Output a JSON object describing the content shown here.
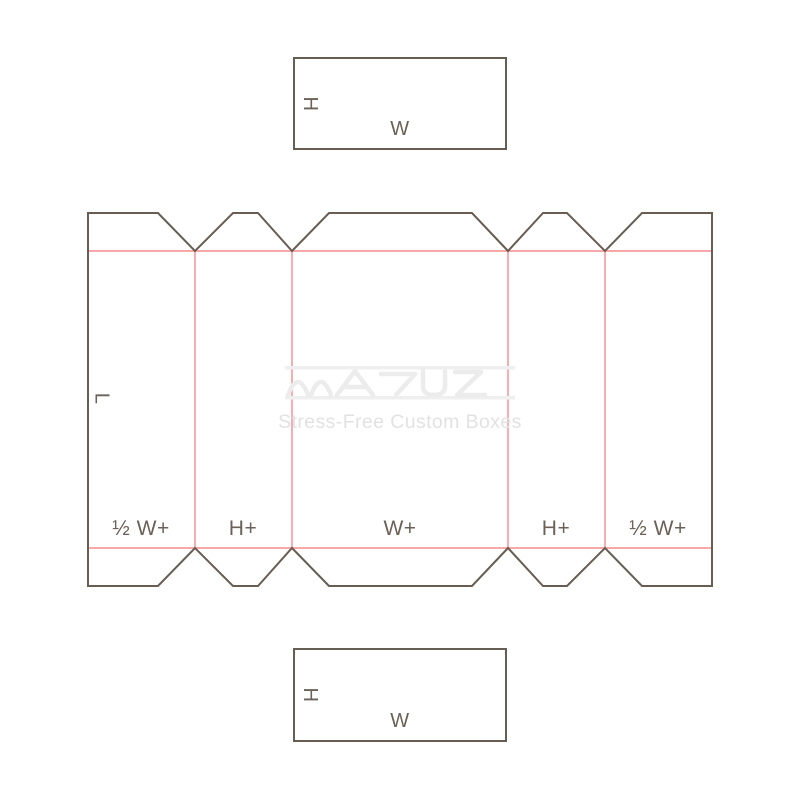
{
  "title": "Box dieline template",
  "colors": {
    "background": "#ffffff",
    "cut_line": "#675d53",
    "fold_line": "#f58b8b",
    "label_text": "#6b6158",
    "watermark_logo": "#ececec",
    "watermark_text": "#e2e2e2"
  },
  "top_panel": {
    "height_label": "H",
    "width_label": "W"
  },
  "dieline": {
    "length_label": "L",
    "panel_labels": [
      "½ W+",
      "H+",
      "W+",
      "H+",
      "½ W+"
    ]
  },
  "watermark": {
    "logo": "matus-wave-wordmark",
    "tagline": "Stress-Free Custom Boxes"
  },
  "bottom_panel": {
    "height_label": "H",
    "width_label": "W"
  }
}
